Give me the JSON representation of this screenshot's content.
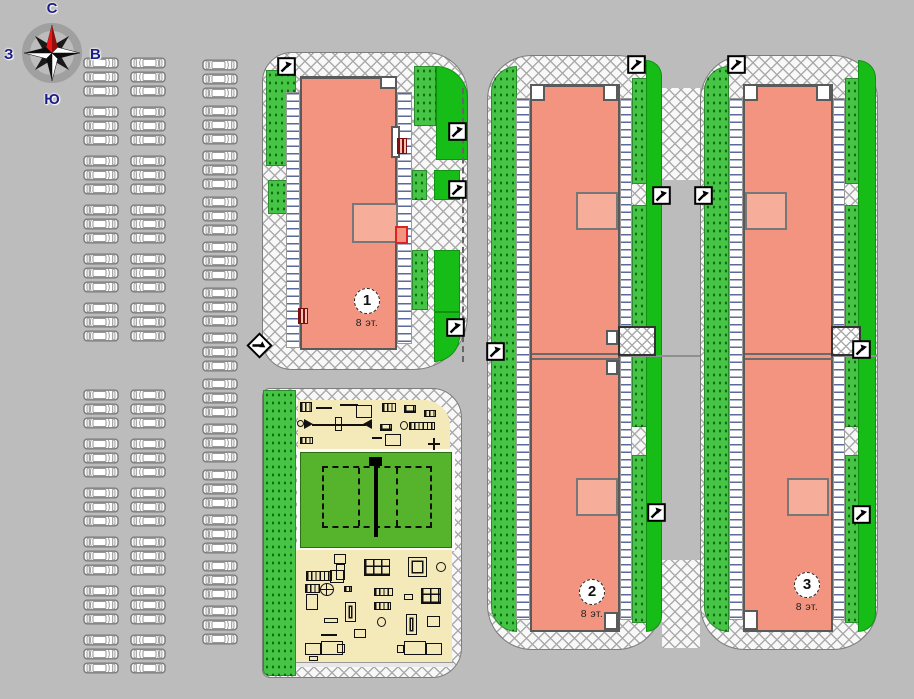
{
  "compass": {
    "north": "С",
    "south": "Ю",
    "west": "З",
    "east": "В"
  },
  "buildings": [
    {
      "number": "1",
      "floors_label": "8 эт."
    },
    {
      "number": "2",
      "floors_label": "8 эт."
    },
    {
      "number": "3",
      "floors_label": "8 эт."
    }
  ],
  "colors": {
    "bg": "#bcbcbc",
    "bld": "#f29480",
    "bld-border": "#5a5a5a",
    "lawn-solid": "#17bd17",
    "lawn-dotted": "#46c446",
    "lawn-dot": "#0d700d",
    "cream": "#f4e9b8",
    "field": "#56b42c",
    "navy": "#1c1c8a",
    "needle-red": "#ef1515",
    "porch": "#f6ad99",
    "joint": "#6a6a6a",
    "hatch-line": "#5a6a9a"
  },
  "parking": {
    "car_width": 36,
    "car_height": 12,
    "lots": [
      {
        "name": "upper-left",
        "x": 83,
        "y": 57,
        "col_offsets": [
          0,
          47
        ],
        "flip_col": 1,
        "groups": 6,
        "rows_per_group": 3,
        "row_pitch": 14,
        "group_gap": 7
      },
      {
        "name": "lower-left",
        "x": 83,
        "y": 389,
        "col_offsets": [
          0,
          47
        ],
        "flip_col": 1,
        "groups": 6,
        "rows_per_group": 3,
        "row_pitch": 14,
        "group_gap": 7
      },
      {
        "name": "middle",
        "x": 202,
        "y": 59,
        "col_offsets": [
          0
        ],
        "flip_col": -1,
        "groups": 13,
        "rows_per_group": 3,
        "row_pitch": 14,
        "group_gap": 3.5
      }
    ]
  },
  "markers": {
    "squares": [
      {
        "x": 277,
        "y": 57
      },
      {
        "x": 448,
        "y": 122
      },
      {
        "x": 448,
        "y": 180
      },
      {
        "x": 446,
        "y": 318
      },
      {
        "x": 627,
        "y": 55
      },
      {
        "x": 652,
        "y": 186
      },
      {
        "x": 694,
        "y": 186
      },
      {
        "x": 486,
        "y": 342
      },
      {
        "x": 647,
        "y": 503
      },
      {
        "x": 727,
        "y": 55
      },
      {
        "x": 852,
        "y": 340
      },
      {
        "x": 852,
        "y": 505
      }
    ],
    "diamonds": [
      {
        "x": 250,
        "y": 336
      }
    ]
  },
  "scene": {
    "shapes": [
      {
        "c": "lawn-d",
        "x": 266,
        "y": 70,
        "w": 30,
        "h": 96
      },
      {
        "c": "lawn-d",
        "x": 268,
        "y": 180,
        "w": 26,
        "h": 34
      },
      {
        "c": "lawn-d",
        "x": 414,
        "y": 66,
        "w": 22,
        "h": 60
      },
      {
        "c": "lawn-s",
        "x": 436,
        "y": 66,
        "w": 32,
        "h": 94,
        "r": "0 40px 0 0"
      },
      {
        "c": "lawn-d",
        "x": 412,
        "y": 170,
        "w": 15,
        "h": 30
      },
      {
        "c": "lawn-s",
        "x": 434,
        "y": 170,
        "w": 26,
        "h": 30
      },
      {
        "c": "lawn-d",
        "x": 412,
        "y": 250,
        "w": 16,
        "h": 60
      },
      {
        "c": "lawn-s",
        "x": 434,
        "y": 250,
        "w": 26,
        "h": 62
      },
      {
        "c": "lawn-s",
        "x": 434,
        "y": 312,
        "w": 26,
        "h": 50,
        "r": "0 0 52px 0"
      },
      {
        "c": "lawn-d",
        "x": 263,
        "y": 390,
        "w": 33,
        "h": 286,
        "r": "0 0 0 6px"
      },
      {
        "c": "lawn-d",
        "x": 491,
        "y": 66,
        "w": 26,
        "h": 566,
        "r": "40px 0 0 40px"
      },
      {
        "c": "lawn-d",
        "x": 632,
        "y": 78,
        "w": 16,
        "h": 106
      },
      {
        "c": "lawn-d",
        "x": 632,
        "y": 205,
        "w": 16,
        "h": 222
      },
      {
        "c": "lawn-d",
        "x": 632,
        "y": 455,
        "w": 16,
        "h": 168
      },
      {
        "c": "lawn-s",
        "x": 646,
        "y": 60,
        "w": 16,
        "h": 572,
        "r": "0 42px 42px 0"
      },
      {
        "c": "lawn-d",
        "x": 704,
        "y": 66,
        "w": 25,
        "h": 566,
        "r": "40px 0 0 40px"
      },
      {
        "c": "lawn-d",
        "x": 845,
        "y": 78,
        "w": 16,
        "h": 106
      },
      {
        "c": "lawn-d",
        "x": 845,
        "y": 205,
        "w": 16,
        "h": 222
      },
      {
        "c": "lawn-d",
        "x": 845,
        "y": 455,
        "w": 16,
        "h": 168
      },
      {
        "c": "lawn-s",
        "x": 858,
        "y": 60,
        "w": 18,
        "h": 572,
        "r": "0 42px 42px 0"
      },
      {
        "c": "hatchv",
        "x": 286,
        "y": 92,
        "w": 14,
        "h": 256
      },
      {
        "c": "hatchv",
        "x": 397,
        "y": 92,
        "w": 15,
        "h": 252
      },
      {
        "c": "hatchv",
        "x": 516,
        "y": 98,
        "w": 14,
        "h": 522
      },
      {
        "c": "hatchv",
        "x": 620,
        "y": 98,
        "w": 12,
        "h": 522
      },
      {
        "c": "hatchv",
        "x": 729,
        "y": 98,
        "w": 14,
        "h": 522
      },
      {
        "c": "hatchv",
        "x": 833,
        "y": 98,
        "w": 12,
        "h": 522
      },
      {
        "c": "jline",
        "x": 532,
        "y": 353,
        "w": 88,
        "h": 2
      },
      {
        "c": "jline",
        "x": 532,
        "y": 358,
        "w": 88,
        "h": 2
      },
      {
        "c": "jline2",
        "x": 620,
        "y": 355,
        "w": 80,
        "h": 2
      },
      {
        "c": "jline",
        "x": 745,
        "y": 353,
        "w": 88,
        "h": 2
      },
      {
        "c": "jline",
        "x": 745,
        "y": 358,
        "w": 88,
        "h": 2
      },
      {
        "c": "jline2",
        "x": 833,
        "y": 355,
        "w": 45,
        "h": 2
      },
      {
        "c": "porch",
        "x": 352,
        "y": 203,
        "w": 46,
        "h": 40
      },
      {
        "c": "porch",
        "x": 576,
        "y": 192,
        "w": 42,
        "h": 38
      },
      {
        "c": "porch",
        "x": 576,
        "y": 478,
        "w": 42,
        "h": 38
      },
      {
        "c": "porch",
        "x": 745,
        "y": 192,
        "w": 42,
        "h": 38
      },
      {
        "c": "porch",
        "x": 787,
        "y": 478,
        "w": 42,
        "h": 38
      },
      {
        "c": "wbox",
        "x": 380,
        "y": 76,
        "w": 17,
        "h": 13
      },
      {
        "c": "wbox",
        "x": 391,
        "y": 126,
        "w": 9,
        "h": 32
      },
      {
        "c": "wbox",
        "x": 530,
        "y": 84,
        "w": 15,
        "h": 17
      },
      {
        "c": "wbox",
        "x": 603,
        "y": 84,
        "w": 15,
        "h": 17
      },
      {
        "c": "wbox",
        "x": 743,
        "y": 84,
        "w": 15,
        "h": 17
      },
      {
        "c": "wbox",
        "x": 816,
        "y": 84,
        "w": 15,
        "h": 17
      },
      {
        "c": "wbox",
        "x": 606,
        "y": 330,
        "w": 12,
        "h": 15
      },
      {
        "c": "wbox",
        "x": 606,
        "y": 360,
        "w": 12,
        "h": 15
      },
      {
        "c": "wbox",
        "x": 604,
        "y": 612,
        "w": 14,
        "h": 18
      },
      {
        "c": "wbox",
        "x": 743,
        "y": 610,
        "w": 15,
        "h": 20
      },
      {
        "c": "bridge",
        "x": 618,
        "y": 326,
        "w": 38,
        "h": 30
      },
      {
        "c": "bridge",
        "x": 831,
        "y": 326,
        "w": 30,
        "h": 30
      },
      {
        "c": "redbar",
        "x": 397,
        "y": 138,
        "w": 10,
        "h": 16
      },
      {
        "c": "redbar",
        "x": 298,
        "y": 308,
        "w": 10,
        "h": 16
      },
      {
        "c": "redbox",
        "x": 395,
        "y": 226,
        "w": 13,
        "h": 18
      },
      {
        "c": "vdash",
        "x": 462,
        "y": 88,
        "w": 1,
        "h": 274
      }
    ]
  },
  "equipment": {
    "items": [
      {
        "c": "hbars",
        "x": 300,
        "y": 402,
        "w": 12,
        "h": 10
      },
      {
        "c": "line",
        "x": 316,
        "y": 407,
        "w": 16,
        "h": 2
      },
      {
        "c": "line",
        "x": 340,
        "y": 404,
        "w": 18,
        "h": 2
      },
      {
        "c": "box",
        "x": 356,
        "y": 405,
        "w": 16,
        "h": 13
      },
      {
        "c": "hbars",
        "x": 382,
        "y": 403,
        "w": 14,
        "h": 9
      },
      {
        "c": "grid4",
        "x": 404,
        "y": 405,
        "w": 12,
        "h": 8
      },
      {
        "c": "hbars",
        "x": 424,
        "y": 410,
        "w": 12,
        "h": 7
      },
      {
        "c": "circle",
        "x": 297,
        "y": 420,
        "w": 7,
        "h": 7
      },
      {
        "c": "trir",
        "x": 304,
        "y": 419
      },
      {
        "c": "line",
        "x": 312,
        "y": 424,
        "w": 54,
        "h": 2
      },
      {
        "c": "box",
        "x": 335,
        "y": 417,
        "w": 7,
        "h": 14
      },
      {
        "c": "tril",
        "x": 363,
        "y": 419
      },
      {
        "c": "hbars",
        "x": 300,
        "y": 437,
        "w": 13,
        "h": 7
      },
      {
        "c": "grid4",
        "x": 380,
        "y": 424,
        "w": 12,
        "h": 7
      },
      {
        "c": "circle",
        "x": 400,
        "y": 421,
        "w": 8,
        "h": 9
      },
      {
        "c": "hbars",
        "x": 409,
        "y": 422,
        "w": 26,
        "h": 8
      },
      {
        "c": "line",
        "x": 372,
        "y": 437,
        "w": 10,
        "h": 2
      },
      {
        "c": "box",
        "x": 385,
        "y": 434,
        "w": 16,
        "h": 12
      },
      {
        "c": "line",
        "x": 428,
        "y": 443,
        "w": 12,
        "h": 2
      },
      {
        "c": "line",
        "x": 433,
        "y": 438,
        "w": 2,
        "h": 12
      },
      {
        "c": "box",
        "x": 334,
        "y": 554,
        "w": 12,
        "h": 10
      },
      {
        "c": "box",
        "x": 336,
        "y": 564,
        "w": 9,
        "h": 16
      },
      {
        "c": "hbars",
        "x": 306,
        "y": 571,
        "w": 26,
        "h": 10
      },
      {
        "c": "box",
        "x": 330,
        "y": 570,
        "w": 14,
        "h": 13
      },
      {
        "c": "grid4",
        "x": 364,
        "y": 559,
        "w": 26,
        "h": 17
      },
      {
        "c": "boxin",
        "x": 408,
        "y": 557,
        "w": 19,
        "h": 20
      },
      {
        "c": "circle",
        "x": 436,
        "y": 562,
        "w": 10,
        "h": 10
      },
      {
        "c": "carousel",
        "x": 320,
        "y": 583,
        "w": 14,
        "h": 13
      },
      {
        "c": "hbars",
        "x": 305,
        "y": 584,
        "w": 15,
        "h": 9
      },
      {
        "c": "box",
        "x": 306,
        "y": 594,
        "w": 12,
        "h": 16
      },
      {
        "c": "hbars",
        "x": 344,
        "y": 586,
        "w": 8,
        "h": 6
      },
      {
        "c": "hbars",
        "x": 374,
        "y": 588,
        "w": 19,
        "h": 8
      },
      {
        "c": "box",
        "x": 404,
        "y": 594,
        "w": 9,
        "h": 6
      },
      {
        "c": "grid4",
        "x": 421,
        "y": 588,
        "w": 20,
        "h": 16
      },
      {
        "c": "boxin",
        "x": 345,
        "y": 602,
        "w": 11,
        "h": 20
      },
      {
        "c": "hbars",
        "x": 374,
        "y": 602,
        "w": 17,
        "h": 8
      },
      {
        "c": "box",
        "x": 324,
        "y": 618,
        "w": 14,
        "h": 5
      },
      {
        "c": "circle",
        "x": 377,
        "y": 617,
        "w": 9,
        "h": 10
      },
      {
        "c": "boxin",
        "x": 406,
        "y": 614,
        "w": 11,
        "h": 21
      },
      {
        "c": "box",
        "x": 427,
        "y": 616,
        "w": 13,
        "h": 11
      },
      {
        "c": "box",
        "x": 354,
        "y": 629,
        "w": 12,
        "h": 9
      },
      {
        "c": "line",
        "x": 321,
        "y": 634,
        "w": 16,
        "h": 2
      },
      {
        "c": "box",
        "x": 305,
        "y": 643,
        "w": 16,
        "h": 12
      },
      {
        "c": "box",
        "x": 321,
        "y": 641,
        "w": 22,
        "h": 14
      },
      {
        "c": "box",
        "x": 337,
        "y": 644,
        "w": 8,
        "h": 9
      },
      {
        "c": "box",
        "x": 404,
        "y": 641,
        "w": 22,
        "h": 14
      },
      {
        "c": "box",
        "x": 426,
        "y": 643,
        "w": 16,
        "h": 12
      },
      {
        "c": "box",
        "x": 397,
        "y": 645,
        "w": 7,
        "h": 8
      },
      {
        "c": "box",
        "x": 309,
        "y": 656,
        "w": 9,
        "h": 5
      }
    ]
  }
}
